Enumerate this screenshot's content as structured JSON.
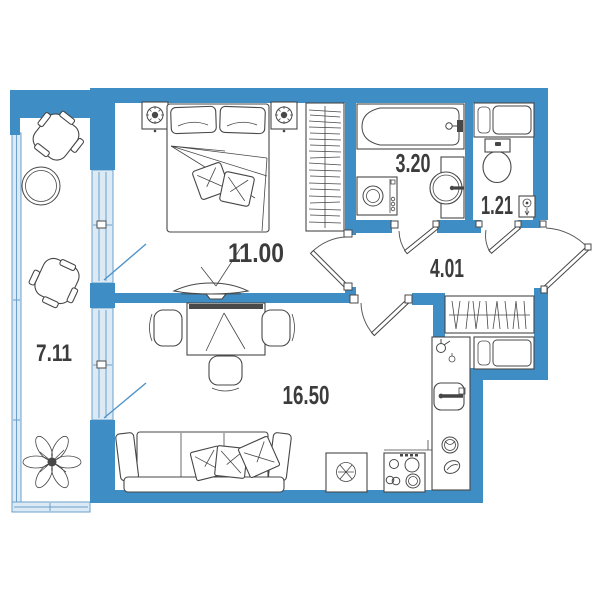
{
  "page": {
    "type": "apartment-floor-plan"
  },
  "rooms": {
    "balcony": {
      "area": "7.11"
    },
    "bedroom": {
      "area": "11.00"
    },
    "bathroom": {
      "area": "3.20"
    },
    "wc": {
      "area": "1.21"
    },
    "hallway": {
      "area": "4.01"
    },
    "living_kitchen": {
      "area": "16.50"
    }
  },
  "colors": {
    "wall": "#3E8EC5",
    "glazing_fill": "#DCEAF6",
    "glazing_border": "#6BA0CB",
    "balcony_door": "#4F94CB",
    "line": "#474747",
    "text": "#3C3C3C"
  },
  "icons": [
    "bed-icon",
    "pillow-icon",
    "nightstand-lamp-icon",
    "wardrobe-hanging-clothes-icon",
    "tv-icon",
    "dining-table-icon",
    "chair-icon",
    "sofa-icon",
    "armchair-icon",
    "round-table-icon",
    "plant-icon",
    "bathtub-icon",
    "washing-machine-icon",
    "washbasin-icon",
    "toilet-icon",
    "drain-icon",
    "kitchen-sink-icon",
    "faucet-icon",
    "fridge-snowflake-icon",
    "stove-burners-icon",
    "shoe-cabinet-icon",
    "door-swing-icon",
    "window-glazing-icon"
  ]
}
